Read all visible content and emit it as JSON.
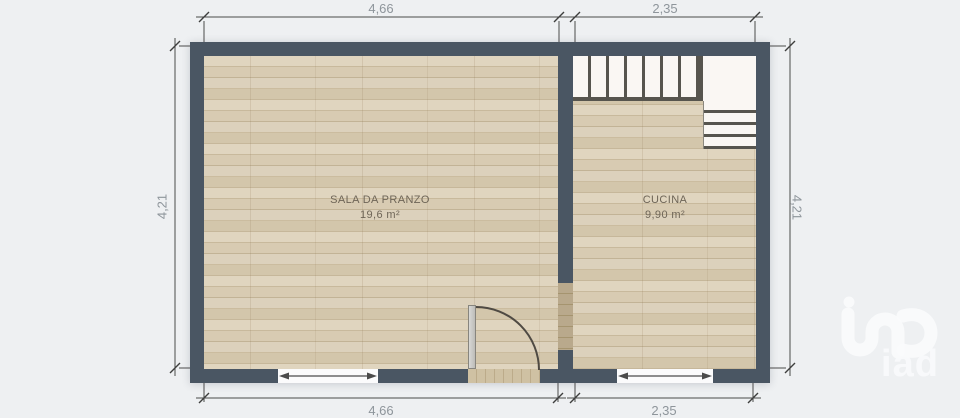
{
  "plan": {
    "rooms": [
      {
        "name": "SALA DA PRANZO",
        "area": "19,6 m²"
      },
      {
        "name": "CUCINA",
        "area": "9,90 m²"
      }
    ]
  },
  "dimensions": {
    "top_left": "4,66",
    "top_right": "2,35",
    "left": "4,21",
    "right": "4,21",
    "bottom_left": "4,66",
    "bottom_right": "2,35"
  },
  "logo": {
    "text": "iad"
  },
  "colors": {
    "background": "#eef0f2",
    "wall": "#4a5663",
    "floor_wood": "#d3c6ab",
    "stair_tread": "#faf7f3",
    "stair_line": "#57554e",
    "dimension_text": "#8e959b",
    "room_text": "#6e6557",
    "watermark": "#fafbfc"
  }
}
